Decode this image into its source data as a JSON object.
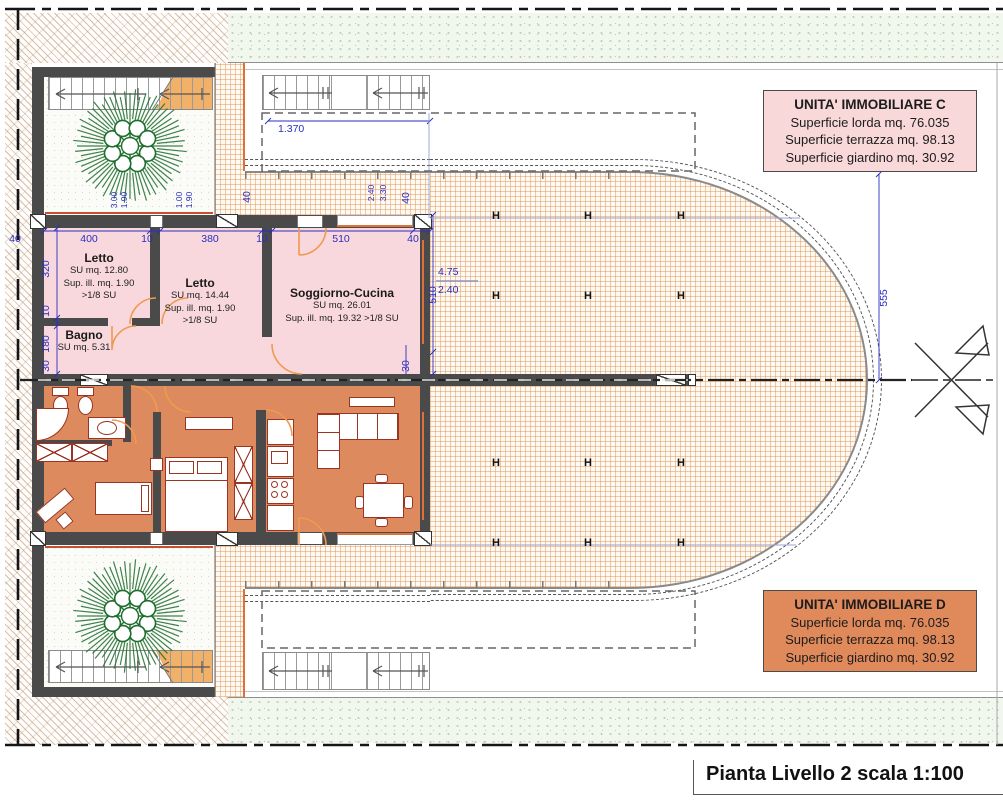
{
  "plan": {
    "title_block": "Pianta Livello 2 scala 1:100",
    "h_marker": "H"
  },
  "units": {
    "c": {
      "title": "UNITA' IMMOBILIARE C",
      "lorda": "Superficie lorda mq. 76.035",
      "terrazza": "Superficie terrazza mq. 98.13",
      "giardino": "Superficie giardino mq. 30.92"
    },
    "d": {
      "title": "UNITA' IMMOBILIARE D",
      "lorda": "Superficie lorda mq. 76.035",
      "terrazza": "Superficie terrazza mq. 98.13",
      "giardino": "Superficie giardino mq. 30.92"
    }
  },
  "rooms": {
    "letto1": {
      "name": "Letto",
      "su": "SU mq. 12.80",
      "ill": "Sup. ill. mq. 1.90",
      "frac": ">1/8 SU"
    },
    "letto2": {
      "name": "Letto",
      "su": "SU mq. 14.44",
      "ill": "Sup. ill. mq. 1.90",
      "frac": ">1/8 SU"
    },
    "soggiorno": {
      "name": "Soggiorno-Cucina",
      "su": "SU mq. 26.01",
      "ill": "Sup. ill. mq. 19.32 >1/8 SU"
    },
    "bagno": {
      "name": "Bagno",
      "su": "SU mq. 5.31"
    }
  },
  "dims": {
    "top": {
      "wall_l": "40",
      "letto1": "400",
      "t1": "10",
      "letto2": "380",
      "t2": "10",
      "sogg": "510",
      "wall_r": "40"
    },
    "left": {
      "letto1_depth": "320",
      "wall": "10",
      "bagno": "180",
      "party": "30"
    },
    "right": {
      "sogg_depth": "510",
      "wall": "30",
      "win_top_l": "40",
      "win_top_r": "40"
    },
    "small": {
      "a": "3.00",
      "b": "1.90",
      "c": "1.00",
      "d": "1.90",
      "e": "2.40",
      "f": "3.30"
    },
    "overall": {
      "stair_width": "1.370",
      "lvl_a": "4.75",
      "lvl_b": "2.40",
      "terrace": "555"
    }
  },
  "colors": {
    "unit_c_fill": "#f8d8dd",
    "unit_d_fill": "#dd8a5e",
    "wall": "#4a4a4a",
    "dimension": "#2a2fc0",
    "terrace_accent": "#e0703a",
    "tree": "#1e6e2e"
  }
}
